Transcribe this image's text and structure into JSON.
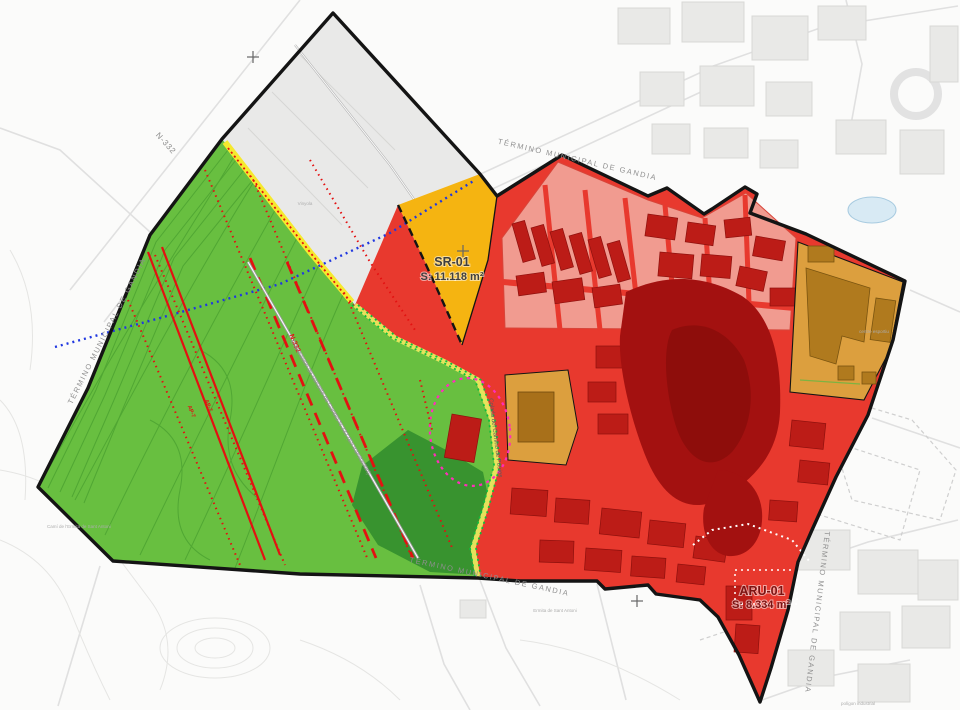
{
  "map": {
    "title_labels": {
      "municipal_boundary": "TÉRMINO MUNICIPAL DE GANDIA"
    },
    "zones": {
      "sr01": {
        "code": "SR-01",
        "area": "S: 11.118 m²",
        "fill": "#f5b411"
      },
      "aru01": {
        "code": "ARU-01",
        "area": "S: 8.334 m²",
        "fill": "#e8392e"
      },
      "rural": {
        "fill": "#68bf40"
      },
      "forest": {
        "fill": "#38932f"
      },
      "reserve_gray": {
        "fill": "#e9e9e8"
      },
      "urban_pink": {
        "fill": "#f19b90"
      },
      "equipment": {
        "fill": "#dc9f3e"
      }
    },
    "roads": {
      "n332": "N-332",
      "ap7": "AP-7",
      "variant": "Duplicación de Variante de Gandia N-332 (En tramitación)",
      "colada": "Colada del Camino de Potries"
    },
    "places": {
      "ermita": "Ermita de Sant Antoni",
      "cami_ermita": "Camí de l'Ermita de Sant Antoni",
      "centre_esportiu": "centre esportiu",
      "poligon_industrial": "polígon industrial",
      "partida": "Vinyola"
    },
    "line_colors": {
      "boundary": "#141414",
      "red_line": "#e31111",
      "blue_line": "#2038e0",
      "magenta": "#ff2dbb",
      "via_green": "#0fbe3c",
      "municipal_label": "#8f8f8f"
    }
  }
}
